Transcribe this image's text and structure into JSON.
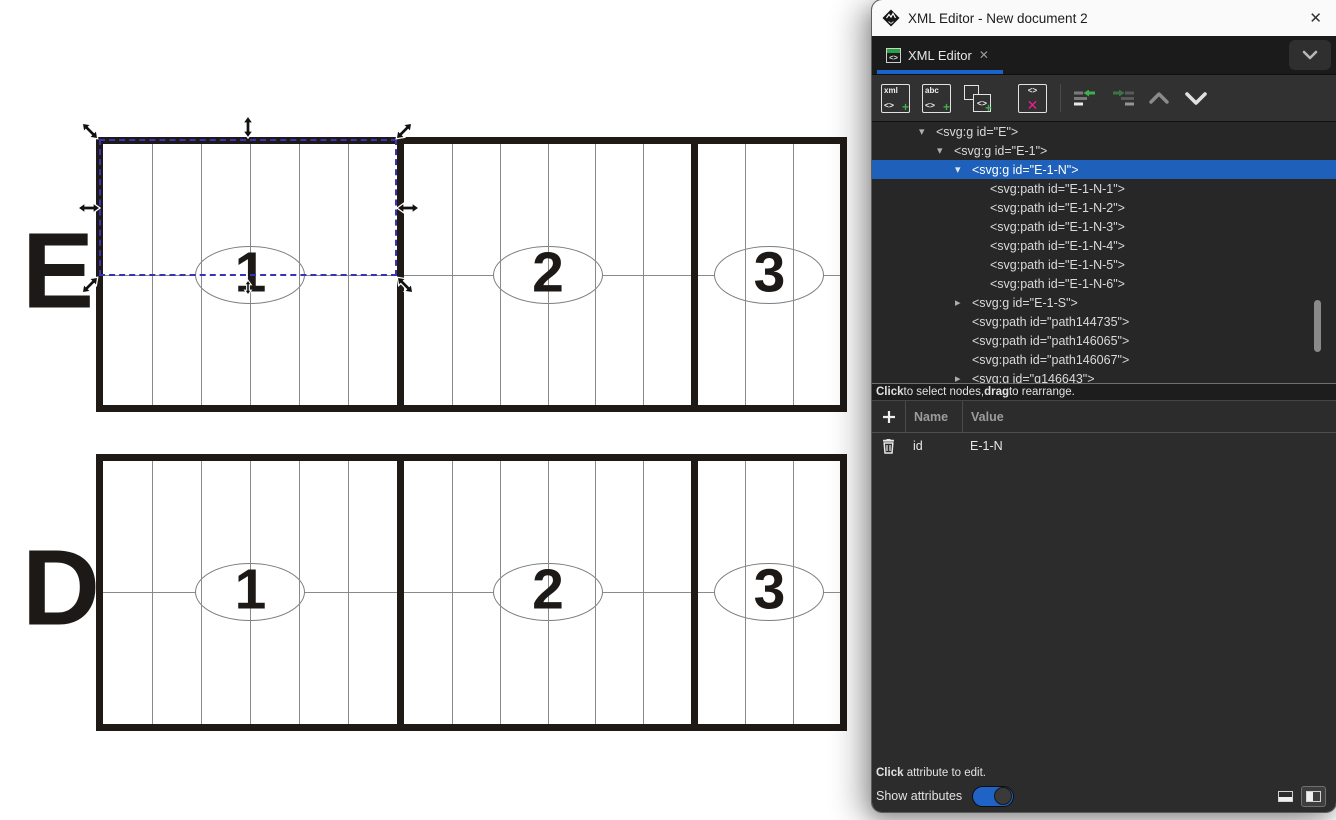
{
  "window": {
    "title": "XML Editor - New document 2",
    "close_glyph": "✕"
  },
  "tab": {
    "label": "XML Editor",
    "close_glyph": "✕",
    "icon": "xml-editor-icon"
  },
  "toolbar": {
    "new_element_node": {
      "text_top": "xml",
      "text_angle": "<>",
      "text_plus": "+"
    },
    "new_text_node": {
      "text_top": "abc",
      "text_angle": "<>",
      "text_plus": "+"
    },
    "duplicate_node": {
      "text_angle": "<>",
      "text_plus": "+"
    },
    "delete_node": {
      "text_angle": "<>",
      "text_x": "✕"
    },
    "unindent_icon": "unindent-node",
    "indent_icon": "indent-node",
    "up_icon": "move-node-up",
    "down_icon": "move-node-down"
  },
  "tree": {
    "hint_parts": [
      {
        "t": "Click",
        "b": true
      },
      {
        "t": " to select nodes, "
      },
      {
        "t": "drag",
        "b": true
      },
      {
        "t": " to rearrange."
      }
    ],
    "rows": [
      {
        "indent": 0,
        "expander": "open",
        "text": "<svg:g id=\"E\">"
      },
      {
        "indent": 1,
        "expander": "open",
        "text": "<svg:g id=\"E-1\">"
      },
      {
        "indent": 2,
        "expander": "open",
        "text": "<svg:g id=\"E-1-N\">",
        "selected": true
      },
      {
        "indent": 3,
        "expander": "none",
        "text": "<svg:path id=\"E-1-N-1\">"
      },
      {
        "indent": 3,
        "expander": "none",
        "text": "<svg:path id=\"E-1-N-2\">"
      },
      {
        "indent": 3,
        "expander": "none",
        "text": "<svg:path id=\"E-1-N-3\">"
      },
      {
        "indent": 3,
        "expander": "none",
        "text": "<svg:path id=\"E-1-N-4\">"
      },
      {
        "indent": 3,
        "expander": "none",
        "text": "<svg:path id=\"E-1-N-5\">"
      },
      {
        "indent": 3,
        "expander": "none",
        "text": "<svg:path id=\"E-1-N-6\">"
      },
      {
        "indent": 2,
        "expander": "closed",
        "text": "<svg:g id=\"E-1-S\">"
      },
      {
        "indent": 2,
        "expander": "none",
        "text": "<svg:path id=\"path144735\">"
      },
      {
        "indent": 2,
        "expander": "none",
        "text": "<svg:path id=\"path146065\">"
      },
      {
        "indent": 2,
        "expander": "none",
        "text": "<svg:path id=\"path146067\">"
      },
      {
        "indent": 2,
        "expander": "closed",
        "text": "<svg:g id=\"g146643\">"
      }
    ]
  },
  "attributes": {
    "headers": {
      "name": "Name",
      "value": "Value"
    },
    "rows": [
      {
        "name": "id",
        "value": "E-1-N"
      }
    ],
    "hint_parts": [
      {
        "t": "Click",
        "b": true
      },
      {
        "t": " attribute to edit."
      }
    ]
  },
  "footer": {
    "show_attributes_label": "Show attributes",
    "toggle_on": true
  },
  "canvas": {
    "rows": [
      {
        "label": "E",
        "sections": [
          {
            "number": "1",
            "columns": 6
          },
          {
            "number": "2",
            "columns": 6
          },
          {
            "number": "3",
            "columns": 3
          }
        ]
      },
      {
        "label": "D",
        "sections": [
          {
            "number": "1",
            "columns": 6
          },
          {
            "number": "2",
            "columns": 6
          },
          {
            "number": "3",
            "columns": 3
          }
        ]
      }
    ],
    "selection": {
      "target": "E-1-N",
      "region": "top half of row E section 1"
    }
  },
  "colors": {
    "selected_row_blue": "#1e60ba",
    "tab_accent_blue": "#1a64c9",
    "toggle_blue": "#1f63c6",
    "plus_green": "#3fae4f",
    "delete_pink": "#ec1e8c",
    "selection_dash_blue": "#3434b8",
    "drawing_stroke": "#1f1a16"
  }
}
